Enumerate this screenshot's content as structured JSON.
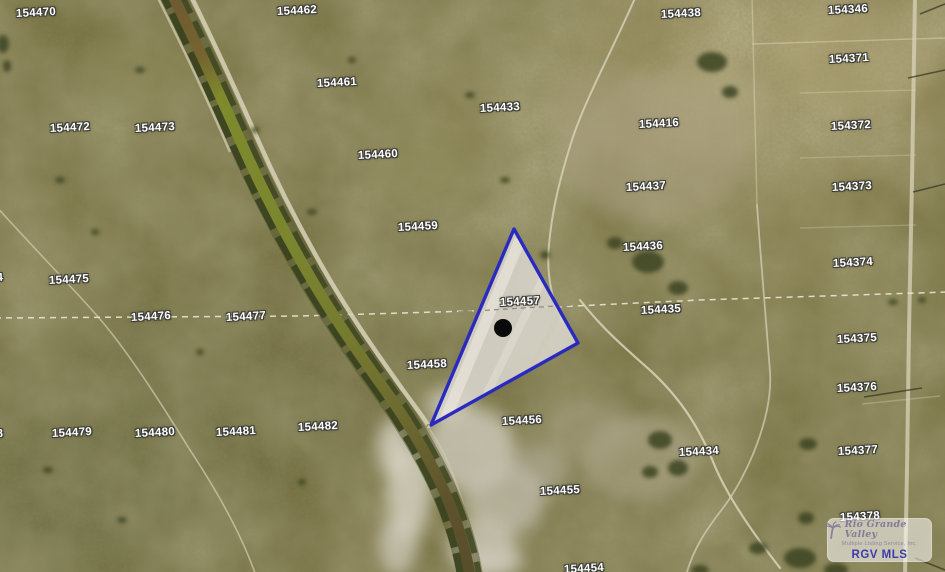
{
  "map": {
    "highlighted_parcel": "154457",
    "highlight_outline_color": "#2a2abf",
    "marker": {
      "x": 503,
      "y": 328,
      "radius": 9,
      "color": "#0a0a0a"
    },
    "label_style": {
      "color": "#ffffff",
      "outline": "#3c3c38"
    },
    "parcel_labels": [
      {
        "text": "154470",
        "x": 36,
        "y": 13
      },
      {
        "text": "154462",
        "x": 297,
        "y": 11
      },
      {
        "text": "154438",
        "x": 681,
        "y": 14
      },
      {
        "text": "154346",
        "x": 848,
        "y": 10
      },
      {
        "text": "154461",
        "x": 337,
        "y": 83
      },
      {
        "text": "154371",
        "x": 849,
        "y": 59
      },
      {
        "text": "154433",
        "x": 500,
        "y": 108
      },
      {
        "text": "154416",
        "x": 659,
        "y": 124
      },
      {
        "text": "154472",
        "x": 70,
        "y": 128
      },
      {
        "text": "154473",
        "x": 155,
        "y": 128
      },
      {
        "text": "154372",
        "x": 851,
        "y": 126
      },
      {
        "text": "154460",
        "x": 378,
        "y": 155
      },
      {
        "text": "154437",
        "x": 646,
        "y": 187
      },
      {
        "text": "154373",
        "x": 852,
        "y": 187
      },
      {
        "text": "154459",
        "x": 418,
        "y": 227
      },
      {
        "text": "154436",
        "x": 643,
        "y": 247
      },
      {
        "text": "154374",
        "x": 853,
        "y": 263
      },
      {
        "text": "154475",
        "x": 69,
        "y": 280
      },
      {
        "text": "154457",
        "x": 520,
        "y": 302
      },
      {
        "text": "154435",
        "x": 661,
        "y": 310
      },
      {
        "text": "154476",
        "x": 151,
        "y": 317
      },
      {
        "text": "154477",
        "x": 246,
        "y": 317
      },
      {
        "text": "154375",
        "x": 857,
        "y": 339
      },
      {
        "text": "154458",
        "x": 427,
        "y": 365
      },
      {
        "text": "154376",
        "x": 857,
        "y": 388
      },
      {
        "text": "154456",
        "x": 522,
        "y": 421
      },
      {
        "text": "154479",
        "x": 72,
        "y": 433
      },
      {
        "text": "154480",
        "x": 155,
        "y": 433
      },
      {
        "text": "154481",
        "x": 236,
        "y": 432
      },
      {
        "text": "154482",
        "x": 318,
        "y": 427
      },
      {
        "text": "154434",
        "x": 699,
        "y": 452
      },
      {
        "text": "154377",
        "x": 858,
        "y": 451
      },
      {
        "text": "154455",
        "x": 560,
        "y": 491
      },
      {
        "text": "154378",
        "x": 860,
        "y": 517
      },
      {
        "text": "154454",
        "x": 584,
        "y": 569
      }
    ],
    "clipped_labels": [
      {
        "text": "4",
        "x": 0,
        "y": 278
      },
      {
        "text": "8",
        "x": 0,
        "y": 434
      }
    ]
  },
  "watermark": {
    "script_line": "Rio Grande Valley",
    "sub_line": "Multiple Listing Service, Inc.",
    "abbr": "RGV MLS",
    "colors": {
      "script": "#86799a",
      "sub": "#8e86a2",
      "abbr": "#3c3bac"
    }
  }
}
